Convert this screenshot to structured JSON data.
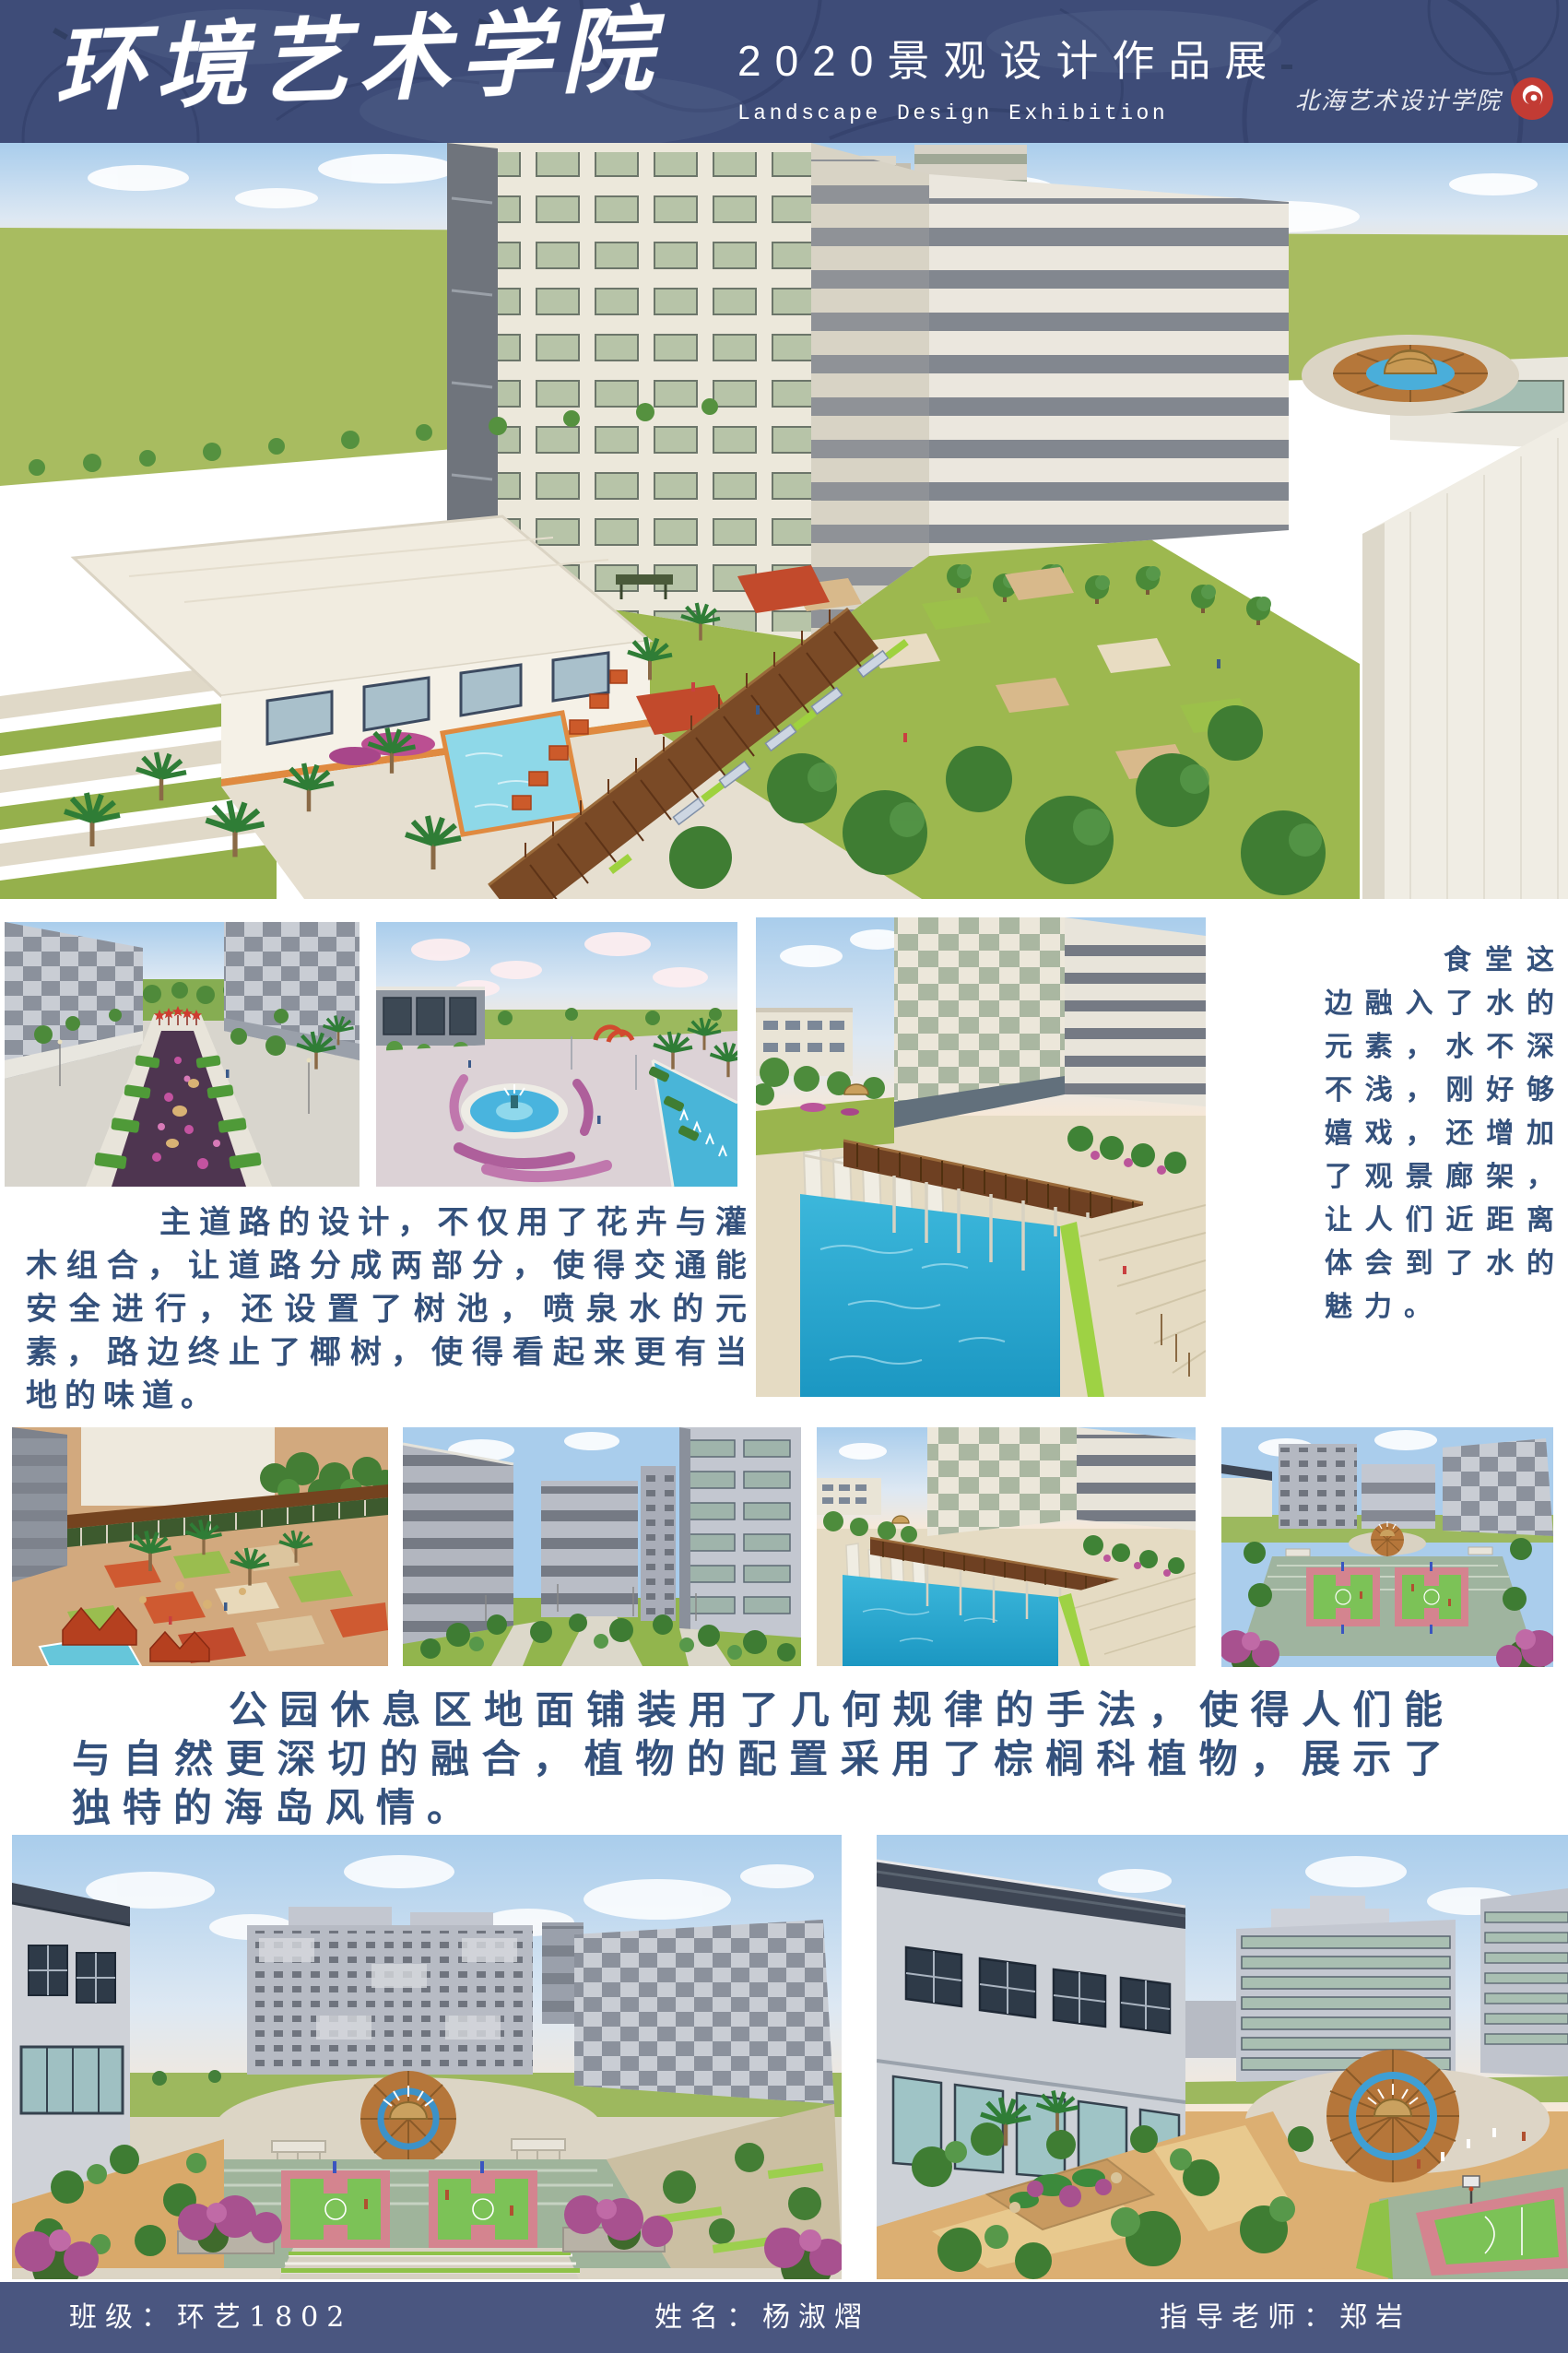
{
  "header": {
    "school_name": "环境艺术学院",
    "title_zh": "2020景观设计作品展",
    "title_en": "Landscape Design Exhibition",
    "institute_seal_text": "北海艺术设计学院"
  },
  "paragraphs": {
    "main_road": "主道路的设计，不仅用了花卉与灌木组合，让道路分成两部分，使得交通能安全进行，还设置了树池，喷泉水的元素，路边终止了椰树，使得看起来更有当地的味道。",
    "canteen_water": "食堂这边融入了水的元素，水不深不浅，刚好够嬉戏，还增加了观景廊架，让人们近距离体会到了水的魅力。",
    "park_rest_area": "公园休息区地面铺装用了几何规律的手法，使得人们能与自然更深切的融合，植物的配置采用了棕榈科植物，展示了独特的海岛风情。"
  },
  "footer": {
    "class_info": "班级：环艺1802",
    "student_name": "姓名：杨淑熠",
    "advisor": "指导老师：郑岩"
  },
  "colors": {
    "header_navy": "#3e4c78",
    "footer_navy": "#4a5680",
    "text_blue": "#34517c",
    "seal_red": "#c23b34"
  }
}
